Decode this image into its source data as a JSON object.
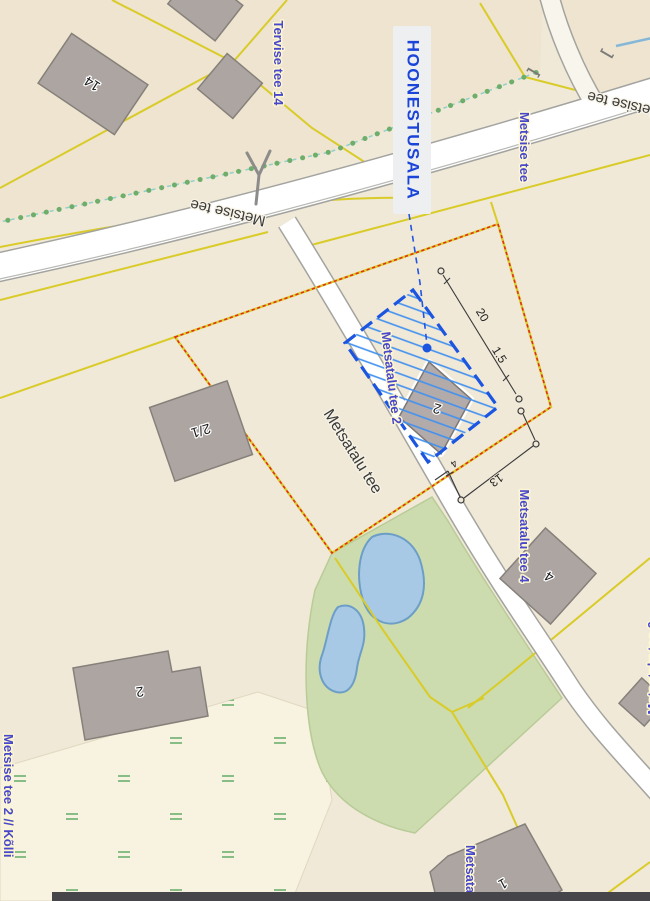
{
  "colors": {
    "base": "#f0e9d8",
    "base_dark": "#eee4cf",
    "meadow_bg": "#f7f3e0",
    "green_area": "#ccdcae",
    "pond_fill": "#a7c9e5",
    "parcel_yellow": "#d9cb28",
    "boundary_red": "#e23018",
    "hoonestusala_blue": "#1b55e0",
    "hatch_blue": "#4190f0",
    "label_blue": "#4848ca",
    "building_fill": "#ada5a2",
    "bottom_bar": "#46464a"
  },
  "plan": {
    "area_label": "HOONESTUSALA",
    "dimensions": {
      "length": "20",
      "offset": "1.5",
      "width": "13",
      "side_offset": "4"
    }
  },
  "streets": {
    "metsise_tee": "Metsise tee",
    "metsatalu_tee": "Metsatalu tee",
    "tervise_tee_14": "Tervise tee 14",
    "metsatalu_tee_2": "Metsatalu tee 2",
    "metsatalu_tee_4": "Metsatalu tee 4",
    "metsatalu_tee_6": "Metsatalu tee 6",
    "metsise_tee_2_kolli": "Metsise tee 2 // Kõlli"
  },
  "buildings": {
    "b14": "14",
    "b21": "2/1",
    "b2_plan": "2",
    "b2": "2",
    "b4": "4",
    "b1": "1"
  },
  "symbols": {
    "bracket_open": "[",
    "bracket_close": "]"
  }
}
